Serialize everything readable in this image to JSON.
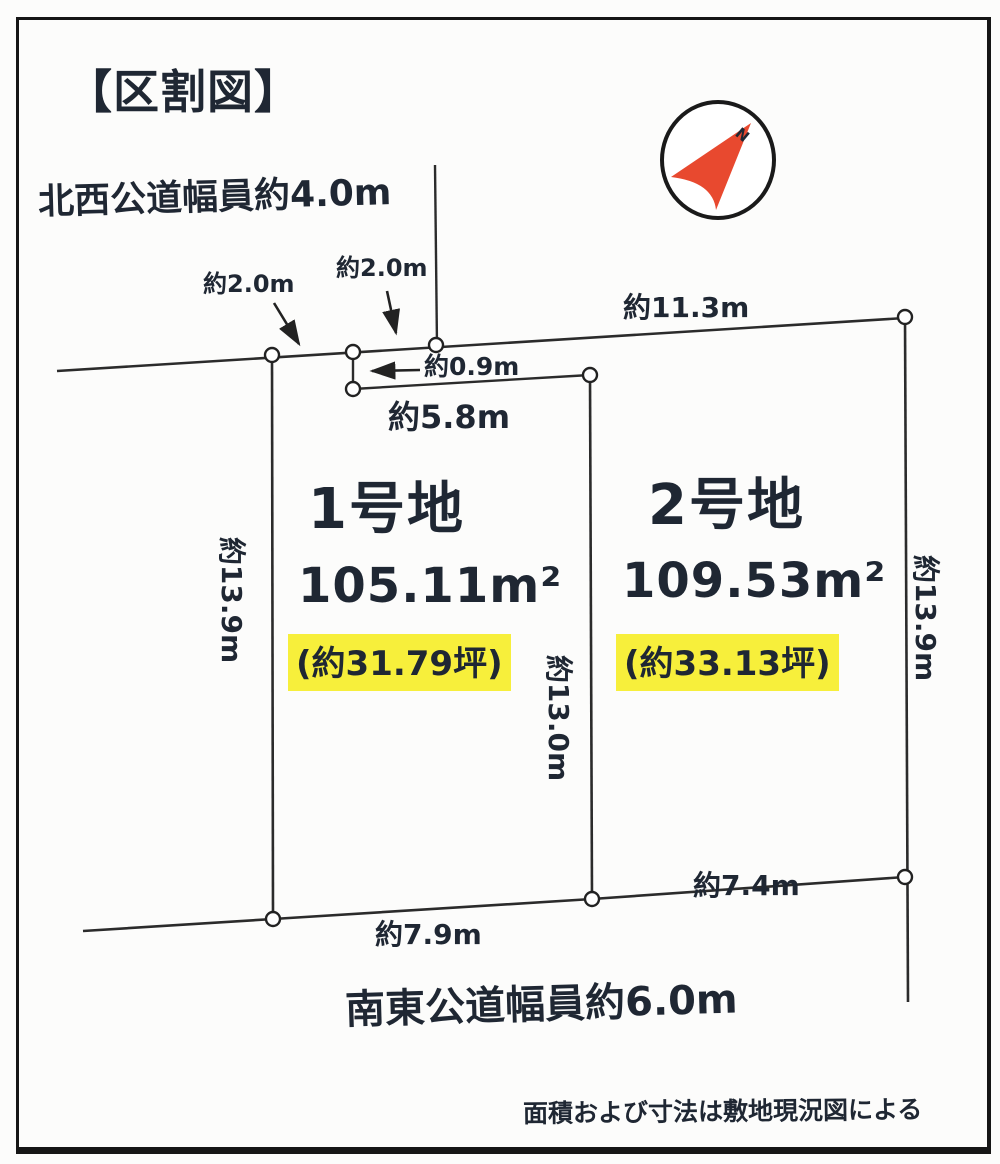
{
  "header": {
    "title": "【区割図】"
  },
  "compass": {
    "label": "N"
  },
  "roads": {
    "northwest": "北西公道幅員約4.0m",
    "southeast": "南東公道幅員約6.0m"
  },
  "dimensions": {
    "top_segment_left": "約2.0m",
    "top_segment_mid": "約2.0m",
    "top_lot2_edge": "約11.3m",
    "setback_depth": "約0.9m",
    "top_lot1_edge": "約5.8m",
    "left_side": "約13.9m",
    "middle_side": "約13.0m",
    "right_side": "約13.9m",
    "bottom_lot1_edge": "約7.9m",
    "bottom_lot2_edge": "約7.4m"
  },
  "lots": [
    {
      "name": "1号地",
      "area_sqm": "105.11m²",
      "area_tsubo": "(約31.79坪)"
    },
    {
      "name": "2号地",
      "area_sqm": "109.53m²",
      "area_tsubo": "(約33.13坪)"
    }
  ],
  "footnote": "面積および寸法は敷地現況図による",
  "colors": {
    "highlight": "#f7ef3b",
    "needle": "#e8492f",
    "ink": "#1f2733"
  }
}
